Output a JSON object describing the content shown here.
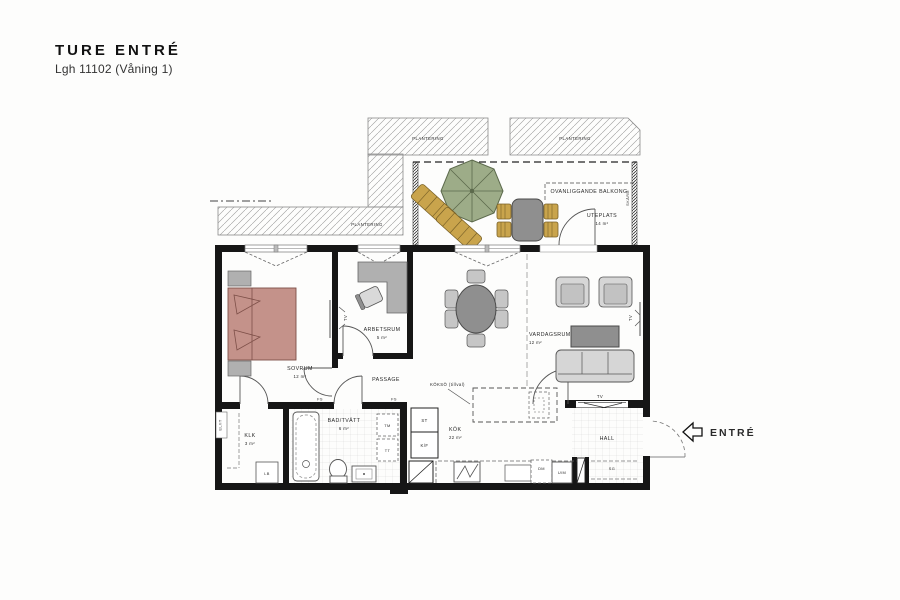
{
  "header": {
    "title": "TURE ENTRÉ",
    "subtitle": "Lgh 11102 (Våning 1)"
  },
  "rooms": {
    "sovrum": {
      "name": "SOVRUM",
      "area": "12 m²"
    },
    "arbetsrum": {
      "name": "ARBETSRUM",
      "area": "5 m²"
    },
    "vardagsrum": {
      "name": "VARDAGSRUM",
      "area": "12 m²"
    },
    "kok": {
      "name": "KÖK",
      "area": "22 m²"
    },
    "bad": {
      "name": "BAD/TVÄTT",
      "area": "6 m²"
    },
    "klk": {
      "name": "KLK",
      "area": "3 m²"
    },
    "passage": {
      "name": "PASSAGE"
    },
    "hall": {
      "name": "HALL"
    },
    "uteplats": {
      "name": "UTEPLATS",
      "area": "14 m²"
    }
  },
  "site": {
    "plantering": "PLANTERING",
    "balcony_above": "OVANLIGGANDE BALKONG",
    "screen": "SKÄRM"
  },
  "fixtures": {
    "koksoe": "KÖKSÖ (tillval)",
    "st": "ST",
    "kf": "K/F",
    "tm": "TM",
    "tt": "TT",
    "dm": "DM",
    "um": "U/M",
    "lb": "LB",
    "sg": "SG",
    "fs": "FS",
    "tv": "TV",
    "elit": "EL/IT"
  },
  "entrance": {
    "label": "ENTRÉ"
  },
  "colors": {
    "wall": "#161616",
    "bed": "#c4928a",
    "bed_stroke": "#7d4f48",
    "parasol": "#9dac88",
    "parasol_stroke": "#5c6a4c",
    "wood": "#c9a44c",
    "wood_stroke": "#7a6228",
    "furniture_light": "#d6d6d6",
    "furniture_mid": "#b0b0b0",
    "furniture_dark": "#8f8f8f"
  }
}
